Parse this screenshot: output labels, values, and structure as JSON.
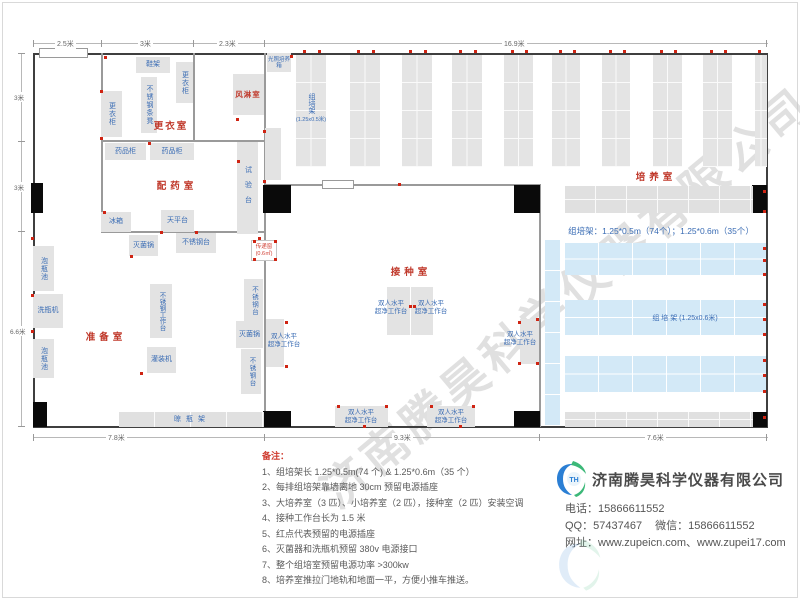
{
  "colors": {
    "room_label": "#c0392b",
    "equipment_label": "#3a6cb4",
    "outlet_dot": "#cf2413",
    "blue_rack": "#d3e9f7",
    "logo_blue": "#2b7fd4",
    "logo_green": "#3cb878"
  },
  "dims": {
    "top": [
      "2.5米",
      "3米",
      "2.3米",
      "16.9米"
    ],
    "left": [
      "3米",
      "3米",
      "6.6米"
    ],
    "bottom": [
      "7.8米",
      "9.3米",
      "7.6米"
    ]
  },
  "rooms": {
    "changing": "更衣室",
    "dispensing": "配药室",
    "air_shower": "风淋室",
    "prep": "准备室",
    "inoculation": "接种室",
    "culture": "培养室"
  },
  "equipment": {
    "shoe_rack": "鞋架",
    "locker": "更衣柜",
    "ss_bench": "不锈钢条凳",
    "light_incubator": "光照培养箱",
    "medicine_cabinet": "药品柜",
    "test_bench": "试验台",
    "fridge": "冰箱",
    "balance_table": "天平台",
    "sterilizer": "灭菌锅",
    "ss_table": "不锈钢台",
    "soak_pool": "泡瓶池",
    "bottle_washer": "洗瓶机",
    "ss_workbench": "不锈钢工作台",
    "filling_machine": "灌装机",
    "drying_rack": "晾瓶架",
    "pass_window": "传递窗",
    "pass_window_area": "(0.6㎡)",
    "clean_bench_line1": "双人水平",
    "clean_bench_line2": "超净工作台",
    "culture_rack": "组培架",
    "culture_rack_size_small": "(1.25x0.5米)",
    "culture_rack_size_big": "组 培 架 (1.25x0.6米)",
    "rack_summary": "组培架：1.25*0.5m（74个）；1.25*0.6m（35个）"
  },
  "notes": {
    "title": "备注：",
    "items": [
      "1、组培架长 1.25*0.5m(74 个) & 1.25*0.6m（35 个）",
      "2、每排组培架靠墙离地 30cm 预留电源插座",
      "3、大培养室（3 匹）、小培养室（2 匹），接种室（2 匹）安装空调",
      "4、接种工作台长为 1.5 米",
      "5、红点代表预留的电源插座",
      "6、灭菌器和洗瓶机预留 380v 电源接口",
      "7、整个组培室预留电源功率 >300kw",
      "8、培养室推拉门地轨和地面一平，方便小推车推送。"
    ]
  },
  "footer": {
    "company": "济南腾昊科学仪器有限公司",
    "phone_label": "电话：",
    "phone": "15866611552",
    "qq_label": "QQ：",
    "qq": "57437467",
    "wechat_label": "微信：",
    "wechat": "15866611552",
    "web_label": "网址：",
    "websites": "www.zupeicn.com、www.zupei17.com",
    "logo_monogram": "TH"
  },
  "watermark": "济南腾昊科学仪器有限公司"
}
